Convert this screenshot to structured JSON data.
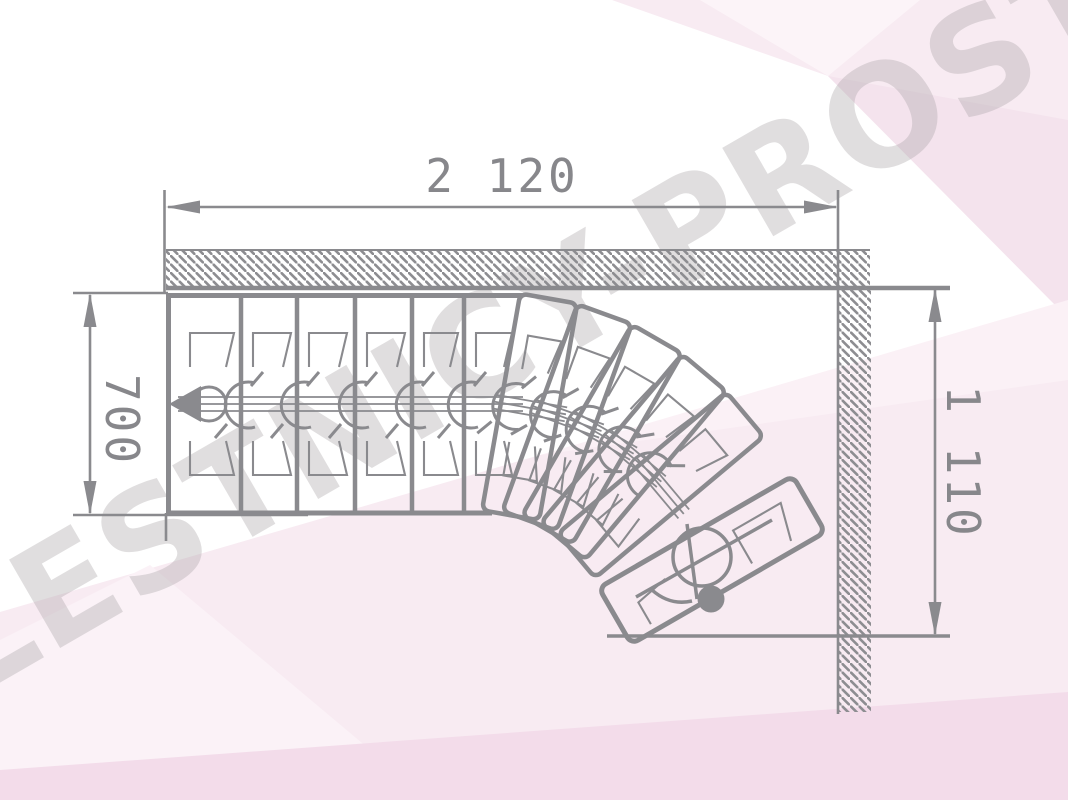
{
  "title": "L-shaped winder staircase plan (top view)",
  "watermark": {
    "text": "LESTNICY-PROSTO.RU"
  },
  "dimensions": {
    "top_width": {
      "label": "2 120"
    },
    "left_depth": {
      "label": "700"
    },
    "right_height": {
      "label": "1 110"
    }
  },
  "stair": {
    "straight_treads": 6,
    "winder_treads": 5,
    "highlighted_treads": 1,
    "total_treads": 12,
    "style": "modular central-stringer staircase with 90-degree winder turn along two hatched walls"
  },
  "colors": {
    "line": "#8a8a8e",
    "text": "#87878b",
    "step_highlight": "#1770bd",
    "watermark": "rgba(173,167,172,0.38)",
    "background": "#ffffff",
    "bg_tint_1": "#f8ebf2",
    "bg_tint_2": "#fcf4f8",
    "bg_tint_3": "#f3dcea",
    "bg_tint_4": "#f4e3ed"
  }
}
